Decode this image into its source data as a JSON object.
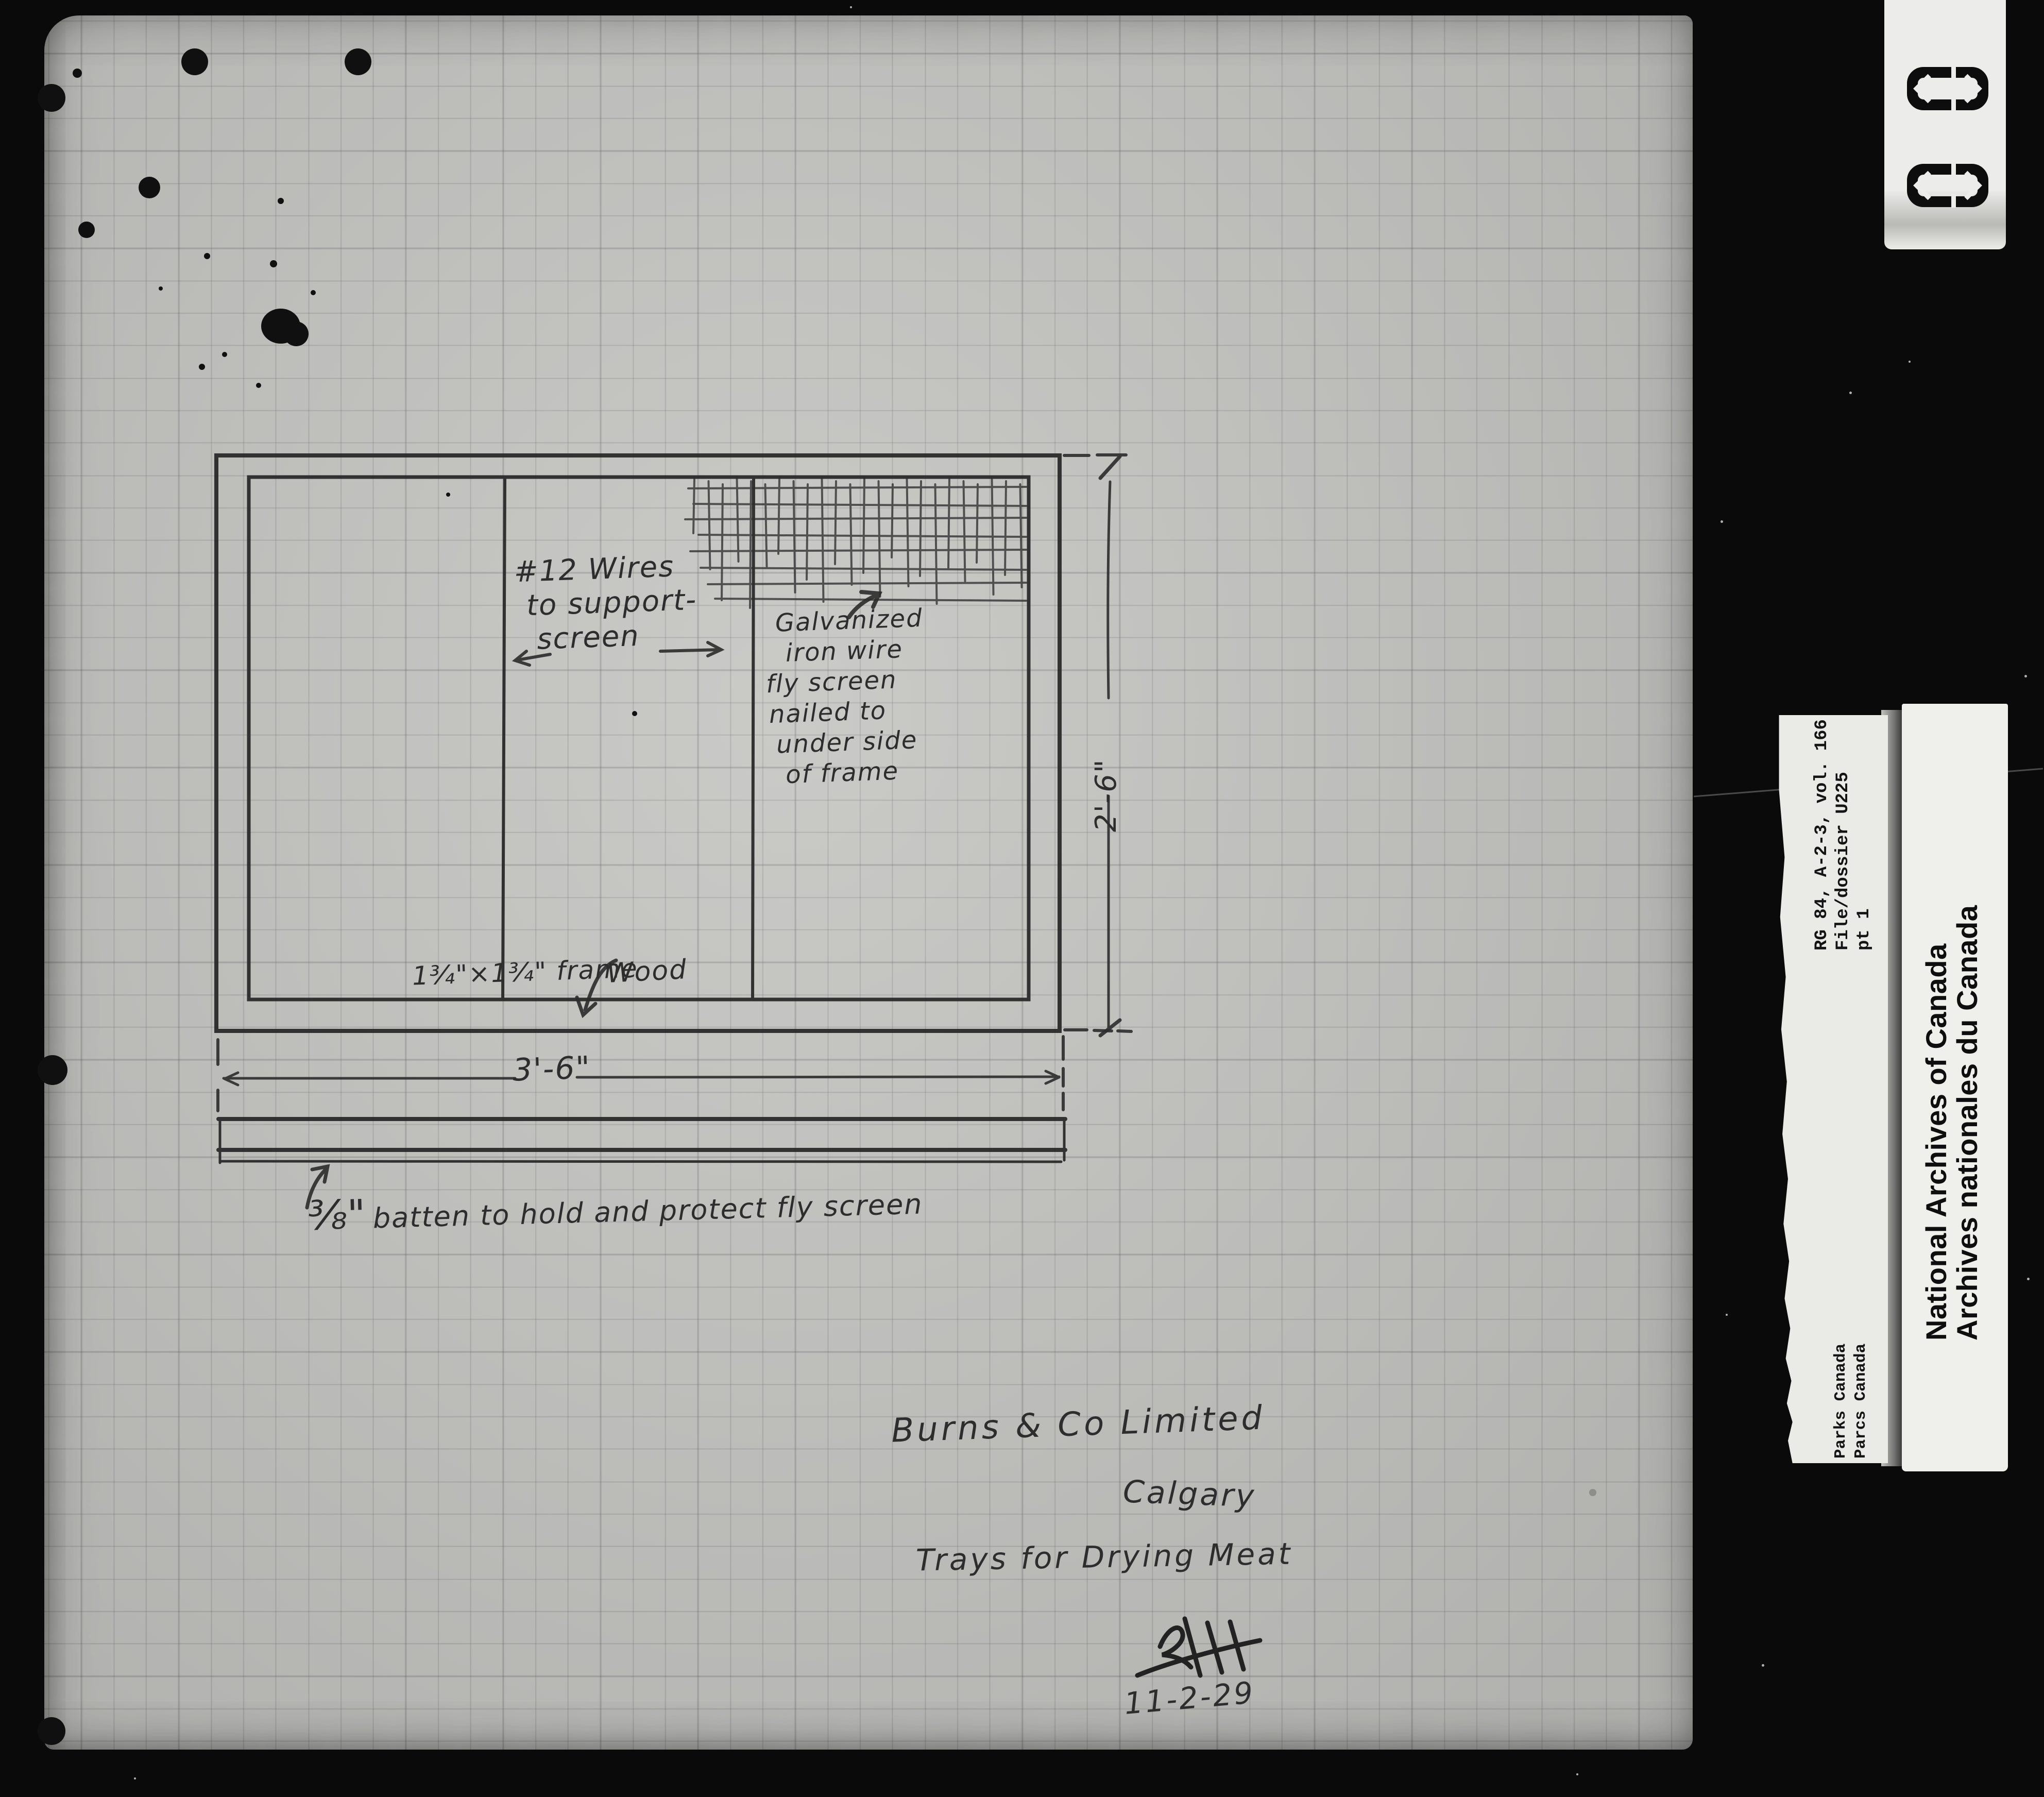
{
  "colors": {
    "background": "#0a0a0a",
    "paper": "#c6c6c3",
    "pencil": "#2c2c2c",
    "label_background": "#eaeae7",
    "label_text": "#141414"
  },
  "sketch": {
    "wires_note": {
      "lines": [
        "#12 Wires",
        "to support-",
        "screen"
      ]
    },
    "screen_note": {
      "lines": [
        "Galvanized",
        "iron wire",
        "fly screen",
        "nailed to",
        "under side",
        "of frame"
      ]
    },
    "frame_note": {
      "size_label": "1¾\"×1¾\" frame",
      "material_label": "Wood"
    },
    "batten_note": {
      "fraction": "⅜\"",
      "text": "batten to hold and protect fly screen"
    },
    "dimensions": {
      "width": "3'-6\"",
      "height": "2'-6\""
    }
  },
  "title_block": {
    "company": "Burns & Co Limited",
    "city": "Calgary",
    "subject": "Trays for Drying Meat",
    "date": "11-2-29"
  },
  "film_labels": {
    "frame_counter": {
      "digits": [
        "0",
        "0"
      ]
    },
    "archive_reference": {
      "lines": [
        "RG 84, A-2-3, vol. 166",
        "File/dossier U225",
        "pt 1"
      ]
    },
    "national_archives": {
      "lines": [
        "National Archives of Canada",
        "Archives nationales du Canada"
      ]
    },
    "parks_canada": {
      "lines": [
        "Parks Canada",
        "Parcs Canada"
      ]
    }
  }
}
